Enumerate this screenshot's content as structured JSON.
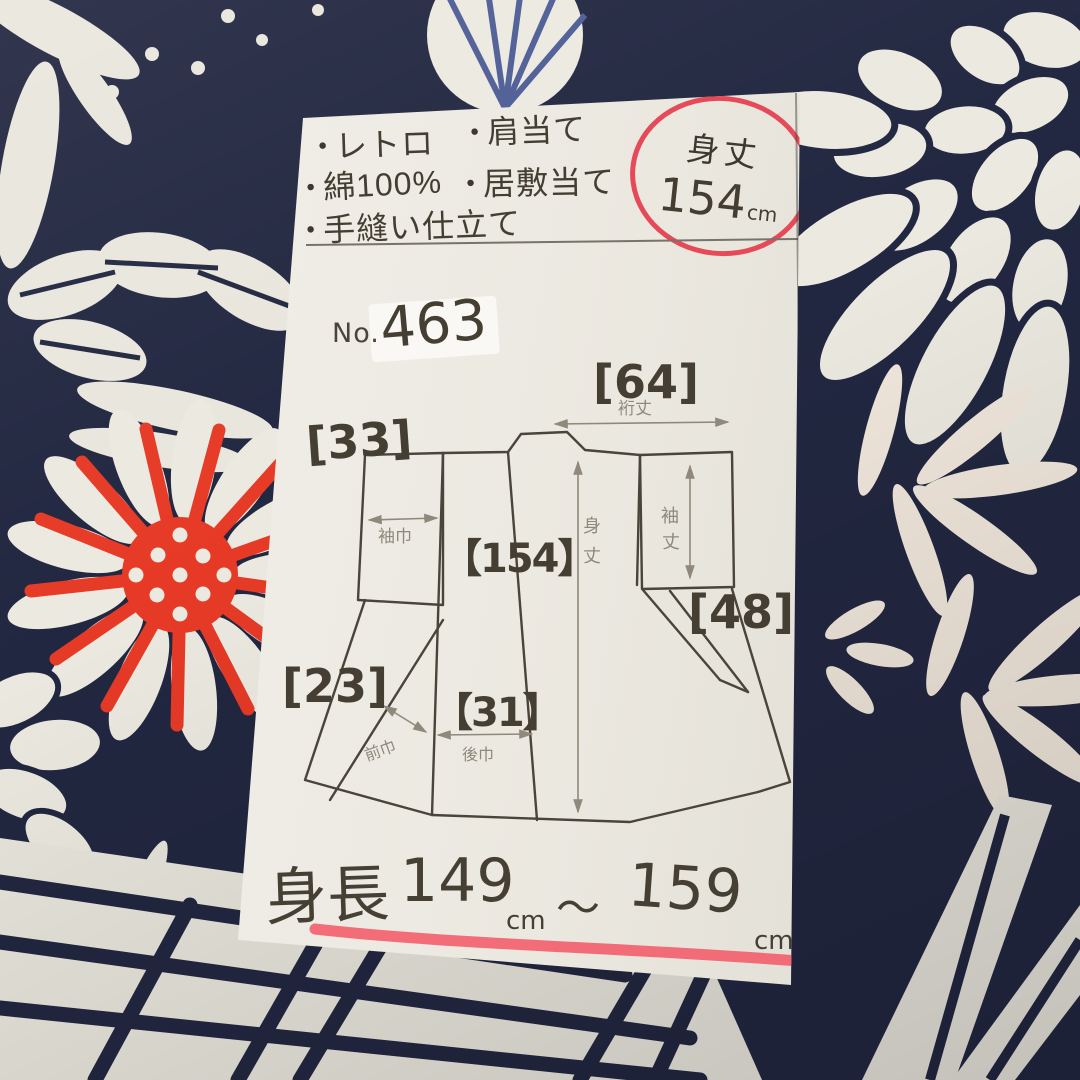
{
  "colors": {
    "fabric_navy": "#222741",
    "fabric_white": "#e9e6dd",
    "fabric_red": "#e63a26",
    "marker_red": "#f2626f",
    "circle_red": "#e64a58",
    "ink": "#443d32",
    "pencil": "#8f897c",
    "paper": "#ebe8e0"
  },
  "note": {
    "bullet_glyph": "●",
    "bullets_left": [
      {
        "label": "レトロ"
      },
      {
        "label": "綿100%"
      },
      {
        "label": "手縫い仕立て"
      }
    ],
    "bullets_right": [
      {
        "label": "肩当て"
      },
      {
        "label": "居敷当て"
      }
    ],
    "size_badge": {
      "label": "身丈",
      "value": "154",
      "unit": "cm"
    },
    "item_no": {
      "prefix": "No.",
      "value": "463"
    },
    "diagram": {
      "yuki_value": "[64]",
      "yuki_label": "裄丈",
      "sodehaba_value": "[33]",
      "sodehaba_label": "袖巾",
      "mitake_value": "【154】",
      "mitake_label_1": "身",
      "mitake_label_2": "丈",
      "sodetake_value": "[48]",
      "sodetake_label_1": "袖",
      "sodetake_label_2": "丈",
      "maehaba_value": "[23]",
      "maehaba_label": "前巾",
      "ushirohaba_value": "【31】",
      "ushirohaba_label": "後巾"
    },
    "height_range": {
      "label": "身長",
      "from": "149",
      "from_unit": "cm",
      "tilde": "～",
      "to": "159",
      "to_unit": "cm"
    }
  }
}
